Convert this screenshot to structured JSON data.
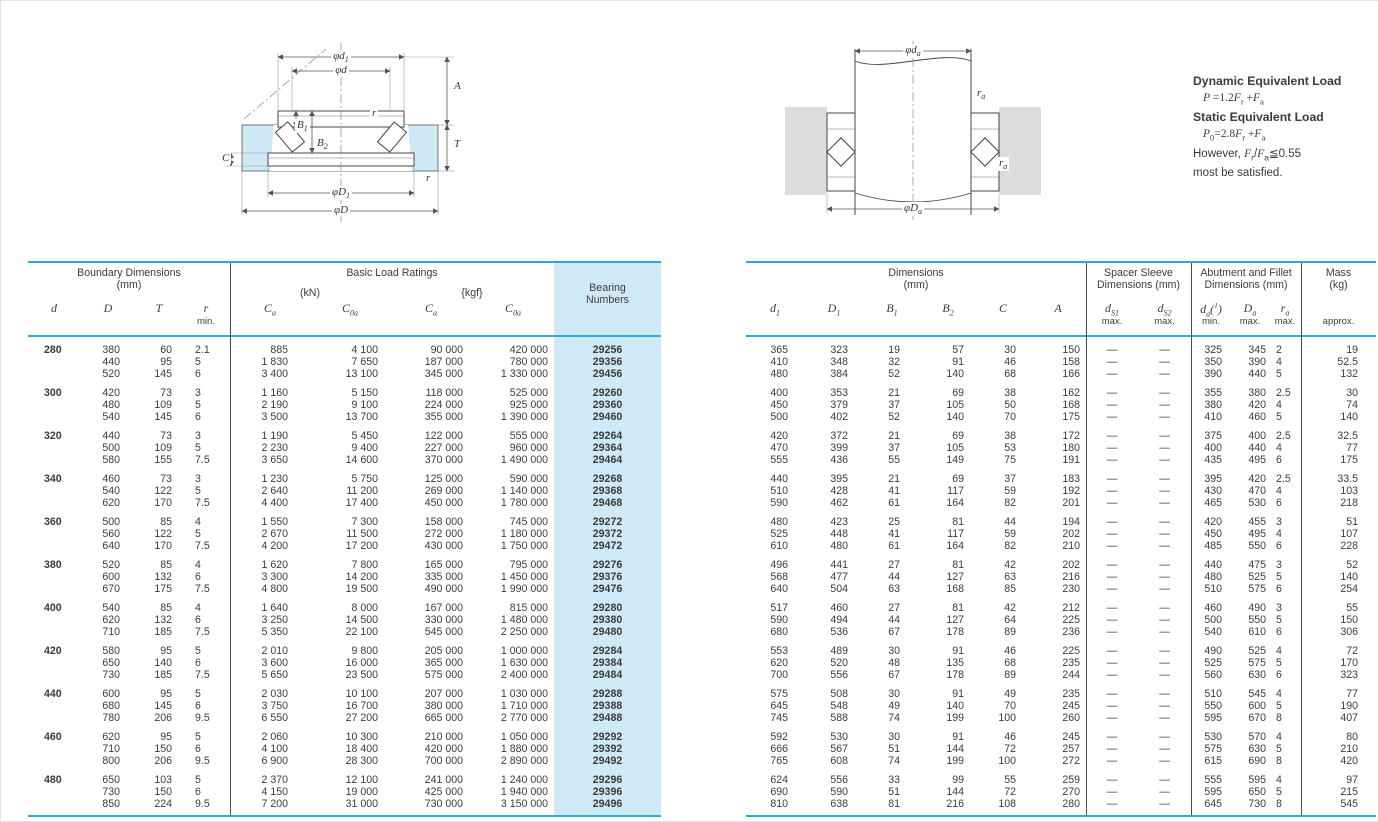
{
  "colors": {
    "accent_cyan": "#2aa9e0",
    "light_blue": "#cfe9f6",
    "housing_gray": "#dcdcdc"
  },
  "formulas": {
    "dynamic_title": "Dynamic Equivalent Load",
    "dynamic_formula": "*P* =1.2*F*_{r} +*F*_{a}",
    "static_title": "Static Equivalent Load",
    "static_formula": "*P*_{0}=2.8*F*_{r} +*F*_{a}",
    "note_line1": "However, *F*_{r}/*F*_{a}≦0.55",
    "note_line2": "most be satisfied."
  },
  "diagram_left": {
    "dim_d1": "φd_{1}",
    "dim_d": "φd",
    "dim_A": "A",
    "dim_r_top": "r",
    "dim_B1": "B_{1}",
    "dim_B2": "B_{2}",
    "dim_C": "C",
    "dim_T": "T",
    "dim_r_bottom": "r",
    "dim_D1": "φD_{1}",
    "dim_D": "φD"
  },
  "diagram_right": {
    "dim_da": "φd_{a}",
    "dim_ra_top": "r_{a}",
    "dim_ra_bottom": "r_{a}",
    "dim_Da": "φD_{a}"
  },
  "left_table": {
    "title_boundary": "Boundary Dimensions",
    "title_boundary_unit": "(mm)",
    "title_loads": "Basic Load Ratings",
    "unit_kn": "(kN)",
    "unit_kgf": "{kgf}",
    "title_bearing1": "Bearing",
    "title_bearing2": "Numbers",
    "symbols": [
      "d",
      "D",
      "T",
      "r",
      "C_{a}",
      "C_{0a}",
      "C_{a}",
      "C_{0a}"
    ],
    "r_caption": "min.",
    "groups": [
      {
        "d": "280",
        "rows": [
          [
            "380",
            "60",
            "2.1",
            "885",
            "4 100",
            "90 000",
            "420 000",
            "29256"
          ],
          [
            "440",
            "95",
            "5",
            "1 830",
            "7 650",
            "187 000",
            "780 000",
            "29356"
          ],
          [
            "520",
            "145",
            "6",
            "3 400",
            "13 100",
            "345 000",
            "1 330 000",
            "29456"
          ]
        ]
      },
      {
        "d": "300",
        "rows": [
          [
            "420",
            "73",
            "3",
            "1 160",
            "5 150",
            "118 000",
            "525 000",
            "29260"
          ],
          [
            "480",
            "109",
            "5",
            "2 190",
            "9 100",
            "224 000",
            "925 000",
            "29360"
          ],
          [
            "540",
            "145",
            "6",
            "3 500",
            "13 700",
            "355 000",
            "1 390 000",
            "29460"
          ]
        ]
      },
      {
        "d": "320",
        "rows": [
          [
            "440",
            "73",
            "3",
            "1 190",
            "5 450",
            "122 000",
            "555 000",
            "29264"
          ],
          [
            "500",
            "109",
            "5",
            "2 230",
            "9 400",
            "227 000",
            "960 000",
            "29364"
          ],
          [
            "580",
            "155",
            "7.5",
            "3 650",
            "14 600",
            "370 000",
            "1 490 000",
            "29464"
          ]
        ]
      },
      {
        "d": "340",
        "rows": [
          [
            "460",
            "73",
            "3",
            "1 230",
            "5 750",
            "125 000",
            "590 000",
            "29268"
          ],
          [
            "540",
            "122",
            "5",
            "2 640",
            "11 200",
            "269 000",
            "1 140 000",
            "29368"
          ],
          [
            "620",
            "170",
            "7.5",
            "4 400",
            "17 400",
            "450 000",
            "1 780 000",
            "29468"
          ]
        ]
      },
      {
        "d": "360",
        "rows": [
          [
            "500",
            "85",
            "4",
            "1 550",
            "7 300",
            "158 000",
            "745 000",
            "29272"
          ],
          [
            "560",
            "122",
            "5",
            "2 670",
            "11 500",
            "272 000",
            "1 180 000",
            "29372"
          ],
          [
            "640",
            "170",
            "7.5",
            "4 200",
            "17 200",
            "430 000",
            "1 750 000",
            "29472"
          ]
        ]
      },
      {
        "d": "380",
        "rows": [
          [
            "520",
            "85",
            "4",
            "1 620",
            "7 800",
            "165 000",
            "795 000",
            "29276"
          ],
          [
            "600",
            "132",
            "6",
            "3 300",
            "14 200",
            "335 000",
            "1 450 000",
            "29376"
          ],
          [
            "670",
            "175",
            "7.5",
            "4 800",
            "19 500",
            "490 000",
            "1 990 000",
            "29476"
          ]
        ]
      },
      {
        "d": "400",
        "rows": [
          [
            "540",
            "85",
            "4",
            "1 640",
            "8 000",
            "167 000",
            "815 000",
            "29280"
          ],
          [
            "620",
            "132",
            "6",
            "3 250",
            "14 500",
            "330 000",
            "1 480 000",
            "29380"
          ],
          [
            "710",
            "185",
            "7.5",
            "5 350",
            "22 100",
            "545 000",
            "2 250 000",
            "29480"
          ]
        ]
      },
      {
        "d": "420",
        "rows": [
          [
            "580",
            "95",
            "5",
            "2 010",
            "9 800",
            "205 000",
            "1 000 000",
            "29284"
          ],
          [
            "650",
            "140",
            "6",
            "3 600",
            "16 000",
            "365 000",
            "1 630 000",
            "29384"
          ],
          [
            "730",
            "185",
            "7.5",
            "5 650",
            "23 500",
            "575 000",
            "2 400 000",
            "29484"
          ]
        ]
      },
      {
        "d": "440",
        "rows": [
          [
            "600",
            "95",
            "5",
            "2 030",
            "10 100",
            "207 000",
            "1 030 000",
            "29288"
          ],
          [
            "680",
            "145",
            "6",
            "3 750",
            "16 700",
            "380 000",
            "1 710 000",
            "29388"
          ],
          [
            "780",
            "206",
            "9.5",
            "6 550",
            "27 200",
            "665 000",
            "2 770 000",
            "29488"
          ]
        ]
      },
      {
        "d": "460",
        "rows": [
          [
            "620",
            "95",
            "5",
            "2 060",
            "10 300",
            "210 000",
            "1 050 000",
            "29292"
          ],
          [
            "710",
            "150",
            "6",
            "4 100",
            "18 400",
            "420 000",
            "1 880 000",
            "29392"
          ],
          [
            "800",
            "206",
            "9.5",
            "6 900",
            "28 300",
            "700 000",
            "2 890 000",
            "29492"
          ]
        ]
      },
      {
        "d": "480",
        "rows": [
          [
            "650",
            "103",
            "5",
            "2 370",
            "12 100",
            "241 000",
            "1 240 000",
            "29296"
          ],
          [
            "730",
            "150",
            "6",
            "4 150",
            "19 000",
            "425 000",
            "1 940 000",
            "29396"
          ],
          [
            "850",
            "224",
            "9.5",
            "7 200",
            "31 000",
            "730 000",
            "3 150 000",
            "29496"
          ]
        ]
      }
    ]
  },
  "right_table": {
    "title_dims": "Dimensions",
    "title_dims_unit": "(mm)",
    "title_spacer1": "Spacer Sleeve",
    "title_spacer2": "Dimensions (mm)",
    "title_abut1": "Abutment and Fillet",
    "title_abut2": "Dimensions (mm)",
    "title_mass1": "Mass",
    "title_mass2": "(kg)",
    "symbols": [
      "d_{1}",
      "D_{1}",
      "B_{1}",
      "B_{2}",
      "C",
      "A",
      "d_{S1}",
      "d_{S2}",
      "d_{a}(^{1})",
      "D_{a}",
      "r_{a}"
    ],
    "captions": [
      "max.",
      "max.",
      "min.",
      "max.",
      "max."
    ],
    "approx_label": "approx.",
    "groups": [
      {
        "rows": [
          [
            "365",
            "323",
            "19",
            "57",
            "30",
            "150",
            "—",
            "—",
            "325",
            "345",
            "2",
            "19"
          ],
          [
            "410",
            "348",
            "32",
            "91",
            "46",
            "158",
            "—",
            "—",
            "350",
            "390",
            "4",
            "52.5"
          ],
          [
            "480",
            "384",
            "52",
            "140",
            "68",
            "166",
            "—",
            "—",
            "390",
            "440",
            "5",
            "132"
          ]
        ]
      },
      {
        "rows": [
          [
            "400",
            "353",
            "21",
            "69",
            "38",
            "162",
            "—",
            "—",
            "355",
            "380",
            "2.5",
            "30"
          ],
          [
            "450",
            "379",
            "37",
            "105",
            "50",
            "168",
            "—",
            "—",
            "380",
            "420",
            "4",
            "74"
          ],
          [
            "500",
            "402",
            "52",
            "140",
            "70",
            "175",
            "—",
            "—",
            "410",
            "460",
            "5",
            "140"
          ]
        ]
      },
      {
        "rows": [
          [
            "420",
            "372",
            "21",
            "69",
            "38",
            "172",
            "—",
            "—",
            "375",
            "400",
            "2.5",
            "32.5"
          ],
          [
            "470",
            "399",
            "37",
            "105",
            "53",
            "180",
            "—",
            "—",
            "400",
            "440",
            "4",
            "77"
          ],
          [
            "555",
            "436",
            "55",
            "149",
            "75",
            "191",
            "—",
            "—",
            "435",
            "495",
            "6",
            "175"
          ]
        ]
      },
      {
        "rows": [
          [
            "440",
            "395",
            "21",
            "69",
            "37",
            "183",
            "—",
            "—",
            "395",
            "420",
            "2.5",
            "33.5"
          ],
          [
            "510",
            "428",
            "41",
            "117",
            "59",
            "192",
            "—",
            "—",
            "430",
            "470",
            "4",
            "103"
          ],
          [
            "590",
            "462",
            "61",
            "164",
            "82",
            "201",
            "—",
            "—",
            "465",
            "530",
            "6",
            "218"
          ]
        ]
      },
      {
        "rows": [
          [
            "480",
            "423",
            "25",
            "81",
            "44",
            "194",
            "—",
            "—",
            "420",
            "455",
            "3",
            "51"
          ],
          [
            "525",
            "448",
            "41",
            "117",
            "59",
            "202",
            "—",
            "—",
            "450",
            "495",
            "4",
            "107"
          ],
          [
            "610",
            "480",
            "61",
            "164",
            "82",
            "210",
            "—",
            "—",
            "485",
            "550",
            "6",
            "228"
          ]
        ]
      },
      {
        "rows": [
          [
            "496",
            "441",
            "27",
            "81",
            "42",
            "202",
            "—",
            "—",
            "440",
            "475",
            "3",
            "52"
          ],
          [
            "568",
            "477",
            "44",
            "127",
            "63",
            "216",
            "—",
            "—",
            "480",
            "525",
            "5",
            "140"
          ],
          [
            "640",
            "504",
            "63",
            "168",
            "85",
            "230",
            "—",
            "—",
            "510",
            "575",
            "6",
            "254"
          ]
        ]
      },
      {
        "rows": [
          [
            "517",
            "460",
            "27",
            "81",
            "42",
            "212",
            "—",
            "—",
            "460",
            "490",
            "3",
            "55"
          ],
          [
            "590",
            "494",
            "44",
            "127",
            "64",
            "225",
            "—",
            "—",
            "500",
            "550",
            "5",
            "150"
          ],
          [
            "680",
            "536",
            "67",
            "178",
            "89",
            "236",
            "—",
            "—",
            "540",
            "610",
            "6",
            "306"
          ]
        ]
      },
      {
        "rows": [
          [
            "553",
            "489",
            "30",
            "91",
            "46",
            "225",
            "—",
            "—",
            "490",
            "525",
            "4",
            "72"
          ],
          [
            "620",
            "520",
            "48",
            "135",
            "68",
            "235",
            "—",
            "—",
            "525",
            "575",
            "5",
            "170"
          ],
          [
            "700",
            "556",
            "67",
            "178",
            "89",
            "244",
            "—",
            "—",
            "560",
            "630",
            "6",
            "323"
          ]
        ]
      },
      {
        "rows": [
          [
            "575",
            "508",
            "30",
            "91",
            "49",
            "235",
            "—",
            "—",
            "510",
            "545",
            "4",
            "77"
          ],
          [
            "645",
            "548",
            "49",
            "140",
            "70",
            "245",
            "—",
            "—",
            "550",
            "600",
            "5",
            "190"
          ],
          [
            "745",
            "588",
            "74",
            "199",
            "100",
            "260",
            "—",
            "—",
            "595",
            "670",
            "8",
            "407"
          ]
        ]
      },
      {
        "rows": [
          [
            "592",
            "530",
            "30",
            "91",
            "46",
            "245",
            "—",
            "—",
            "530",
            "570",
            "4",
            "80"
          ],
          [
            "666",
            "567",
            "51",
            "144",
            "72",
            "257",
            "—",
            "—",
            "575",
            "630",
            "5",
            "210"
          ],
          [
            "765",
            "608",
            "74",
            "199",
            "100",
            "272",
            "—",
            "—",
            "615",
            "690",
            "8",
            "420"
          ]
        ]
      },
      {
        "rows": [
          [
            "624",
            "556",
            "33",
            "99",
            "55",
            "259",
            "—",
            "—",
            "555",
            "595",
            "4",
            "97"
          ],
          [
            "690",
            "590",
            "51",
            "144",
            "72",
            "270",
            "—",
            "—",
            "595",
            "650",
            "5",
            "215"
          ],
          [
            "810",
            "638",
            "81",
            "216",
            "108",
            "280",
            "—",
            "—",
            "645",
            "730",
            "8",
            "545"
          ]
        ]
      }
    ]
  }
}
